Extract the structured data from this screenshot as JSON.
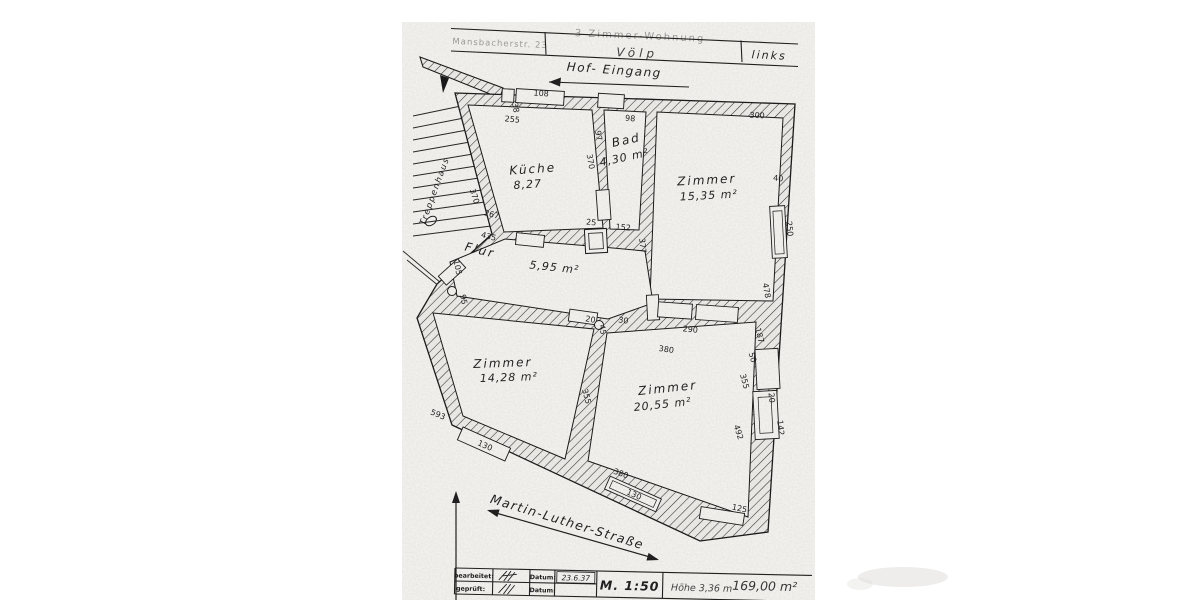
{
  "header": {
    "left_cell": "Mansbacherstr. 23",
    "center_top": "3 Zimmer-Wohnung",
    "center": "Völp",
    "right_cell": "links"
  },
  "annotations": {
    "hof_eingang": "Hof- Eingang",
    "street": "Martin-Luther-Straße",
    "treppenhaus": "Treppenhaus"
  },
  "plan": {
    "rooms": [
      {
        "name": "Küche",
        "area": "8,27",
        "nx": 533,
        "ny": 173,
        "nr": -4,
        "ax": 528,
        "ay": 188,
        "ar": -4
      },
      {
        "name": "Bad",
        "area": "4,30 m²",
        "nx": 627,
        "ny": 144,
        "nr": -12,
        "ax": 625,
        "ay": 161,
        "ar": -12
      },
      {
        "name": "Zimmer",
        "area": "15,35 m²",
        "nx": 707,
        "ny": 184,
        "nr": -3,
        "ax": 709,
        "ay": 199,
        "ar": -3
      },
      {
        "name": "Flur",
        "area": "5,95 m²",
        "nx": 479,
        "ny": 254,
        "nr": 14,
        "ax": 554,
        "ay": 271,
        "ar": 6
      },
      {
        "name": "Zimmer",
        "area": "14,28 m²",
        "nx": 503,
        "ny": 367,
        "nr": -2,
        "ax": 509,
        "ay": 381,
        "ar": -2
      },
      {
        "name": "Zimmer",
        "area": "20,55 m²",
        "nx": 668,
        "ny": 392,
        "nr": -6,
        "ax": 663,
        "ay": 408,
        "ar": -6
      }
    ],
    "dimensions": [
      {
        "t": "108",
        "x": 541,
        "y": 96,
        "r": 4
      },
      {
        "t": "38",
        "x": 513,
        "y": 108,
        "r": 80,
        "s": 7
      },
      {
        "t": "255",
        "x": 512,
        "y": 122,
        "r": 6,
        "s": 7.5
      },
      {
        "t": "370",
        "x": 472,
        "y": 197,
        "r": 72
      },
      {
        "t": "267",
        "x": 491,
        "y": 217,
        "r": 14
      },
      {
        "t": "435",
        "x": 488,
        "y": 239,
        "r": 14
      },
      {
        "t": "105",
        "x": 455,
        "y": 268,
        "r": 78,
        "s": 7
      },
      {
        "t": "95",
        "x": 461,
        "y": 300,
        "r": 78,
        "s": 7
      },
      {
        "t": "97",
        "x": 596,
        "y": 136,
        "r": 80,
        "s": 7.5
      },
      {
        "t": "370",
        "x": 588,
        "y": 162,
        "r": 80
      },
      {
        "t": "98",
        "x": 630,
        "y": 121,
        "r": 5
      },
      {
        "t": "25",
        "x": 591,
        "y": 225,
        "r": 5,
        "s": 6.5
      },
      {
        "t": "152",
        "x": 623,
        "y": 230,
        "r": 5,
        "s": 7.5
      },
      {
        "t": "377",
        "x": 640,
        "y": 246,
        "r": 84
      },
      {
        "t": "300",
        "x": 757,
        "y": 118,
        "r": 3
      },
      {
        "t": "40",
        "x": 778,
        "y": 181,
        "r": 5,
        "s": 7.5
      },
      {
        "t": "250",
        "x": 787,
        "y": 229,
        "r": 84
      },
      {
        "t": "478",
        "x": 764,
        "y": 291,
        "r": 80
      },
      {
        "t": "187",
        "x": 757,
        "y": 336,
        "r": 75,
        "s": 7.5
      },
      {
        "t": "50",
        "x": 750,
        "y": 358,
        "r": 75,
        "s": 7
      },
      {
        "t": "355",
        "x": 742,
        "y": 382,
        "r": 75
      },
      {
        "t": "20",
        "x": 769,
        "y": 398,
        "r": 84,
        "s": 6.5
      },
      {
        "t": "142",
        "x": 778,
        "y": 428,
        "r": 84,
        "s": 7
      },
      {
        "t": "492",
        "x": 736,
        "y": 433,
        "r": 72
      },
      {
        "t": "290",
        "x": 690,
        "y": 332,
        "r": 6
      },
      {
        "t": "30",
        "x": 623,
        "y": 323,
        "r": 8,
        "s": 7
      },
      {
        "t": "20",
        "x": 590,
        "y": 322,
        "r": 10,
        "s": 6.5
      },
      {
        "t": "45",
        "x": 600,
        "y": 330,
        "r": 80,
        "s": 6.5
      },
      {
        "t": "380",
        "x": 666,
        "y": 352,
        "r": 8
      },
      {
        "t": "355",
        "x": 584,
        "y": 397,
        "r": 75
      },
      {
        "t": "593",
        "x": 437,
        "y": 417,
        "r": 22
      },
      {
        "t": "130",
        "x": 484,
        "y": 448,
        "r": 24,
        "s": 7.5
      },
      {
        "t": "130",
        "x": 633,
        "y": 497,
        "r": 24,
        "s": 7.5
      },
      {
        "t": "380",
        "x": 620,
        "y": 476,
        "r": 20
      },
      {
        "t": "125",
        "x": 739,
        "y": 511,
        "r": 12
      }
    ]
  },
  "title_block": {
    "bearbeitet_label": "bearbeitet:",
    "geprueft_label": "geprüft:",
    "datum_label_1": "Datum:",
    "datum_label_2": "Datum:",
    "date_value": "23.6.37",
    "scale": "M. 1:50",
    "height_note": "Höhe 3,36 m",
    "area_note": "169,00 m²"
  }
}
